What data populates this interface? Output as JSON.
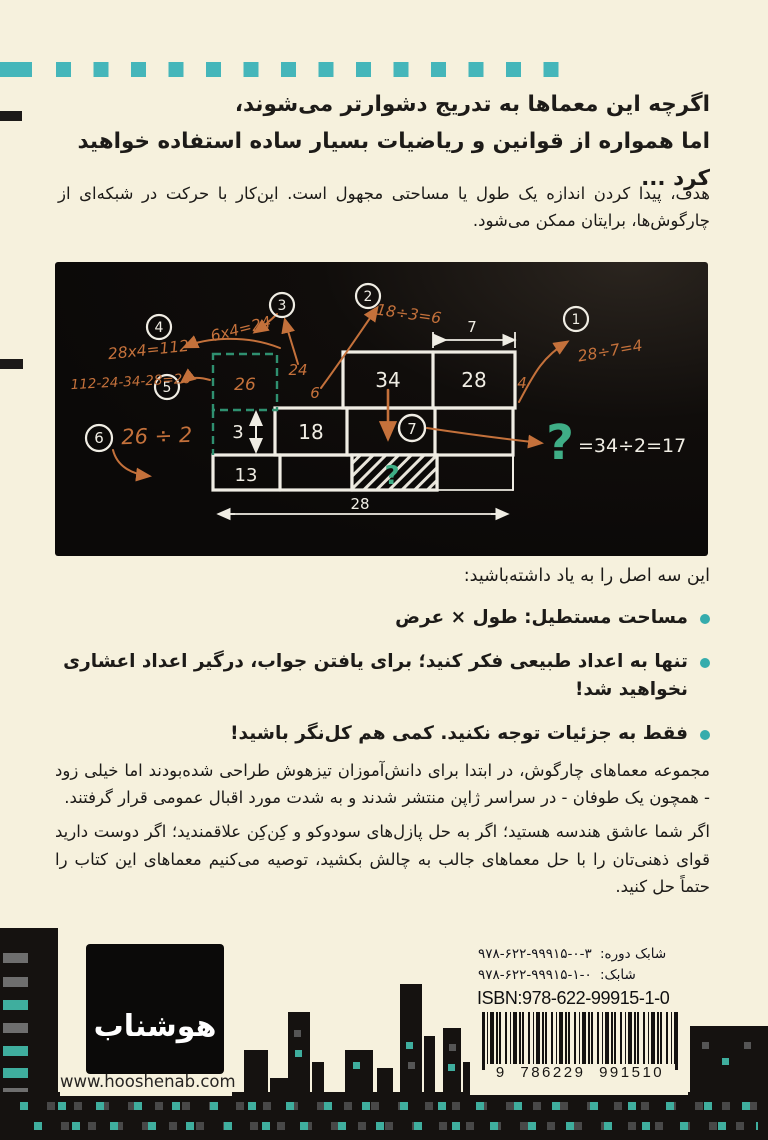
{
  "page": {
    "background": "#f6f1dd",
    "accent_teal": "#45b6ba",
    "accent_orange": "#c4713b",
    "board_green": "#3fae86"
  },
  "intro": {
    "heading_line1": "اگرچه این معماها به تدریج دشوارتر می‌شوند،",
    "heading_line2": "اما همواره از قوانین و ریاضیات بسیار ساده استفاده خواهید کرد ...",
    "paragraph": "هدف، پیدا کردن اندازه یک طول یا مساحتی مجهول است. این‌کار با حرکت در شبکه‌ای از چارگوش‌ها، برایتان ممکن می‌شود."
  },
  "board": {
    "steps": [
      "1",
      "2",
      "3",
      "4",
      "5",
      "6",
      "7"
    ],
    "equations": {
      "step1": "28÷7=4",
      "step2": "18÷3=6",
      "step3": "6x4=24",
      "step4": "28x4=112",
      "step5": "112-24-34-28=26",
      "step6": "26 ÷ 2"
    },
    "cells": {
      "area34": "34",
      "area28": "28",
      "area18": "18",
      "height3": "3",
      "area13": "13",
      "unknown": "?"
    },
    "dimensions": {
      "top_width": "7",
      "bottom_width": "28",
      "right_height": "4"
    },
    "notes": {
      "n26": "26",
      "n24": "24",
      "n6": "6"
    },
    "answer_mark": "?",
    "answer": "=34÷2=17"
  },
  "principles": {
    "intro": "این سه اصل را به یاد داشته‌باشید:",
    "items": [
      "مساحت مستطیل: طول × عرض",
      "تنها به اعداد طبیعی فکر کنید؛ برای یافتن جواب، درگیر اعداد اعشاری نخواهید شد!",
      "فقط به جزئیات توجه نکنید. کمی هم کل‌نگر باشید!"
    ]
  },
  "body": {
    "paragraph1": "مجموعه معماهای چارگوش، در ابتدا برای دانش‌آموزان تیزهوش طراحی شده‌بودند اما خیلی زود - همچون یک طوفان - در سراسر ژاپن منتشر شدند و به شدت مورد اقبال عمومی قرار گرفتند.",
    "paragraph2": "اگر شما عاشق هندسه هستید؛ اگر به حل پازل‌های سودوکو و کِن‌کِن علاقمندید؛ اگر دوست دارید قوای ذهنی‌تان را با حل معماهای جالب به چالش بکشید، توصیه می‌کنیم معماهای این کتاب را حتماً حل کنید."
  },
  "footer": {
    "publisher_logo_text": "هوشناب",
    "website": "www.hooshenab.com",
    "isbn": {
      "line1_label": "شابک دوره:",
      "line1_value": "۹۷۸-۶۲۲-۹۹۹۱۵-۰-۳",
      "line2_label": "شابک:",
      "line2_value": "۹۷۸-۶۲۲-۹۹۹۱۵-۱-۰",
      "line3": "ISBN:978-622-99915-1-0",
      "barcode_number": "9 786229 991510"
    }
  }
}
